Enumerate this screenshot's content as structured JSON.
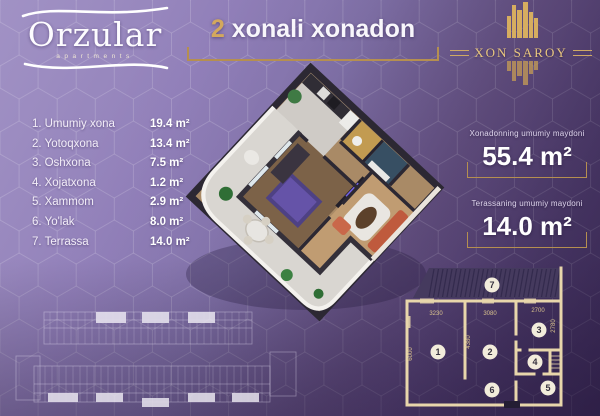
{
  "header": {
    "logo": {
      "name": "Orzular",
      "subtitle": "apartments"
    },
    "title": {
      "number": "2",
      "rest": "xonali xonadon"
    },
    "brand": {
      "name": "XON SAROY"
    }
  },
  "rooms": {
    "items": [
      {
        "num": "1.",
        "name": "Umumiy xona",
        "area": "19.4 m²"
      },
      {
        "num": "2.",
        "name": "Yotoqxona",
        "area": "13.4 m²"
      },
      {
        "num": "3.",
        "name": "Oshxona",
        "area": "7.5 m²"
      },
      {
        "num": "4.",
        "name": "Xojatxona",
        "area": "1.2 m²"
      },
      {
        "num": "5.",
        "name": "Xammom",
        "area": "2.9 m²"
      },
      {
        "num": "6.",
        "name": "Yo'lak",
        "area": "8.0 m²"
      },
      {
        "num": "7.",
        "name": "Terrassa",
        "area": "14.0 m²"
      }
    ]
  },
  "summary": {
    "apartment": {
      "label": "Xonadonning umumiy maydoni",
      "value": "55.4 m²"
    },
    "terrace": {
      "label": "Terassaning umumiy maydoni",
      "value": "14.0 m²"
    }
  },
  "plan2d": {
    "dims": {
      "w1": "3230",
      "w2": "3080",
      "w3": "2700",
      "h1": "6000",
      "h2": "4380",
      "h3": "2780"
    },
    "labels": {
      "r1": "1",
      "r2": "2",
      "r3": "3",
      "r4": "4",
      "r5": "5",
      "r6": "6",
      "r7": "7"
    }
  },
  "colors": {
    "accent_gold": "#c9a05f",
    "background_purple": "#8a77b0",
    "plan_line_cream": "#e8d6ab",
    "text_white": "#f7f4fb"
  }
}
